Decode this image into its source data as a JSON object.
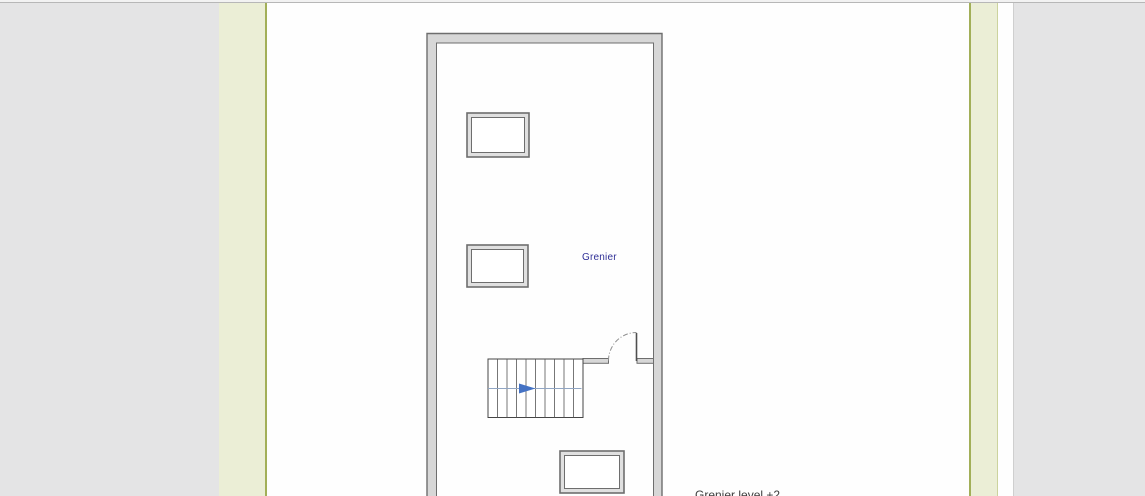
{
  "app": {
    "canvas_background": "#e4e4e5",
    "page_background": "#fefefe",
    "template_band_color": "#ebeed6",
    "template_border_color": "#a2af58"
  },
  "drawing": {
    "room_label": "Grenier",
    "caption": "Grenier level +2",
    "room_label_color": "#2f2f96",
    "caption_color": "#3c3c3c",
    "wall_fill": "#d7d7d7",
    "wall_edge": "#6e6e6e",
    "stair_arrow_color": "#4472c4",
    "stair_centerline_color": "#91a6c4"
  }
}
